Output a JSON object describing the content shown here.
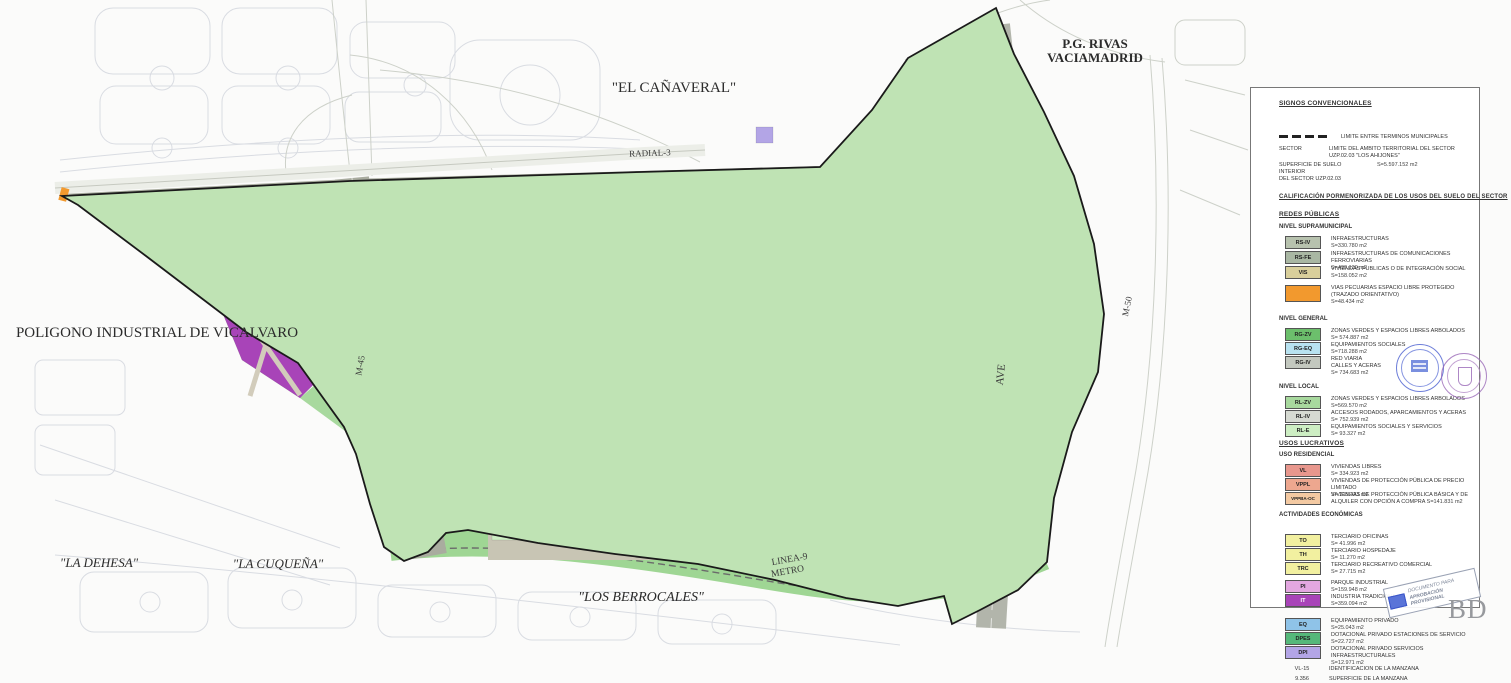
{
  "map": {
    "labels": {
      "el_canaveral": "\"EL CAÑAVERAL\"",
      "pg_rivas_1": "P.G. RIVAS",
      "pg_rivas_2": "VACIAMADRID",
      "poligono": "POLIGONO INDUSTRIAL DE VICALVARO",
      "la_dehesa": "\"LA DEHESA\"",
      "la_cuquena": "\"LA CUQUEÑA\"",
      "los_berrocales": "\"LOS BERROCALES\"",
      "linea9": "LINEA-9",
      "metro": "METRO",
      "radial3": "RADIAL-3",
      "m45": "M-45",
      "m50": "M-50",
      "ave": "AVE"
    }
  },
  "colors": {
    "green_general": "#58b158",
    "green_local": "#a8d99e",
    "green_pale": "#cdeec3",
    "blue_equipment": "#b8e2f0",
    "blue_private": "#8fc3e8",
    "salmon_vl": "#e8978d",
    "salmon_vppl": "#eda78f",
    "peach_vppba": "#f3c9a2",
    "yellow_terciario": "#f2f0a0",
    "khaki_vis": "#d9cf9b",
    "gray_infra": "#b7c2ae",
    "gray_rail": "#a9b7a3",
    "gray_roads": "#c3c8bf",
    "gray_local_roads": "#d6dad2",
    "orchid_pi": "#e3a7e0",
    "purple_it": "#a844b8",
    "violet_dpi": "#b3a5e6",
    "green_dpes": "#55b87a",
    "orange_pecuaria": "#f2992e"
  },
  "legend": {
    "title": "SIGNOS CONVENCIONALES",
    "municipal_limit": "LIMITE ENTRE TERMINOS MUNICIPALES",
    "sector_word": "SECTOR",
    "sector_limit": "LIMITE DEL AMBITO TERRITORIAL DEL SECTOR UZP.02.03 \"LOS AHIJONES\"",
    "interior_surface_label_1": "SUPERFICIE DE SUELO INTERIOR",
    "interior_surface_label_2": "DEL SECTOR UZP.02.03",
    "interior_surface_value": "S=5.597.152 m2",
    "calification_title": "CALIFICACIÓN PORMENORIZADA DE LOS USOS DEL SUELO DEL SECTOR",
    "redes_title": "REDES PÚBLICAS",
    "supra_title": "NIVEL SUPRAMUNICIPAL",
    "general_title": "NIVEL GENERAL",
    "local_title": "NIVEL LOCAL",
    "lucrativos_title": "USOS LUCRATIVOS",
    "residencial_title": "USO RESIDENCIAL",
    "economicas_title": "ACTIVIDADES ECONÓMICAS",
    "supra": [
      {
        "code": "RS-IV",
        "name": "INFRAESTRUCTURAS",
        "area": "S=330.780 m2",
        "color": "#b7c2ae"
      },
      {
        "code": "RS-FE",
        "name": "INFRAESTRUCTURAS DE COMUNICACIONES FERROVIARIAS",
        "area": "S=490.139 m2",
        "color": "#a9b7a3"
      },
      {
        "code": "VIS",
        "name": "VIVIENDAS PUBLICAS O DE INTEGRACIÓN SOCIAL",
        "area": "S=158.052 m2",
        "color": "#d9cf9b"
      },
      {
        "code": "",
        "name": "VIAS PECUARIAS ESPACIO LIBRE PROTEGIDO (TRAZADO ORIENTATIVO)",
        "area": "S=48.434 m2",
        "color": "#f2992e"
      }
    ],
    "general": [
      {
        "code": "RG-ZV",
        "name": "ZONAS VERDES Y ESPACIOS LIBRES ARBOLADOS",
        "area": "S= 574.887 m2",
        "color": "#6cbf6c"
      },
      {
        "code": "RG-EQ",
        "name": "EQUIPAMIENTOS  SOCIALES",
        "area": "S=718.288 m2",
        "color": "#b8e2f0"
      },
      {
        "code": "RG-IV",
        "name": "RED VIARIA",
        "name2": "CALLES Y ACERAS",
        "area": "S= 734.683 m2",
        "color": "#c3c8bf"
      }
    ],
    "local": [
      {
        "code": "RL-ZV",
        "name": "ZONAS VERDES Y ESPACIOS LIBRES ARBOLADOS",
        "area": "S=569.570 m2",
        "color": "#a8d99e"
      },
      {
        "code": "RL-IV",
        "name": "ACCESOS RODADOS, APARCAMIENTOS Y ACERAS",
        "area": "S= 752.939 m2",
        "color": "#d6dad2"
      },
      {
        "code": "RL-E",
        "name": "EQUIPAMIENTOS SOCIALES Y SERVICIOS",
        "area": "S= 93.327 m2",
        "color": "#cdeec3"
      }
    ],
    "residencial": [
      {
        "code": "VL",
        "name": "VIVIENDAS LIBRES",
        "area": "S= 334.923 m2",
        "color": "#e8978d"
      },
      {
        "code": "VPPL",
        "name": "VIVIENDAS DE PROTECCIÓN PÚBLICA DE PRECIO LIMITADO",
        "area": "S= 215.423 m2",
        "color": "#eda78f"
      },
      {
        "code": "VPPBA-OC",
        "name": "VIVIENDAS DE PROTECCIÓN PÚBLICA BÁSICA Y DE ALQUILER CON OPCIÓN A COMPRA",
        "area": "S=141.831 m2",
        "color": "#f3c9a2"
      }
    ],
    "economicas": [
      {
        "code": "TO",
        "name": "TERCIARIO OFICINAS",
        "area": "S= 41.996 m2",
        "color": "#f2f0a0"
      },
      {
        "code": "TH",
        "name": "TERCIARIO HOSPEDAJE",
        "area": "S= 11.270 m2",
        "color": "#f2f0a0"
      },
      {
        "code": "TRC",
        "name": "TERCIARIO RECREATIVO COMERCIAL",
        "area": "S= 27.715 m2",
        "color": "#f2f0a0"
      },
      {
        "code": "PI",
        "name": "PARQUE INDUSTRIAL",
        "area": "S=159.948 m2",
        "color": "#e3a7e0"
      },
      {
        "code": "IT",
        "name": "INDUSTRIA TRADICIONAL",
        "area": "S=359.094 m2",
        "color": "#a844b8"
      }
    ],
    "privados": [
      {
        "code": "EQ",
        "name": "EQUIPAMIENTO PRIVADO",
        "area": "S=25.043 m2",
        "color": "#8fc3e8"
      },
      {
        "code": "DPES",
        "name": "DOTACIONAL PRIVADO ESTACIONES DE SERVICIO",
        "area": "S=22.727 m2",
        "color": "#55b87a"
      },
      {
        "code": "DPI",
        "name": "DOTACIONAL PRIVADO SERVICIOS INFRAESTRUCTURALES",
        "area": "S=12.971 m2",
        "color": "#b3a5e6"
      }
    ],
    "id_code": "VL-15",
    "id_label": "IDENTIFICACION DE LA MANZANA",
    "surf_code": "9.356",
    "surf_label": "SUPERFICIE DE LA MANZANA"
  },
  "stamps": {
    "approval_line_1": "DOCUMENTO PARA",
    "approval_line_2": "APROBACIÓN PROVISIONAL",
    "bd": "BD"
  }
}
